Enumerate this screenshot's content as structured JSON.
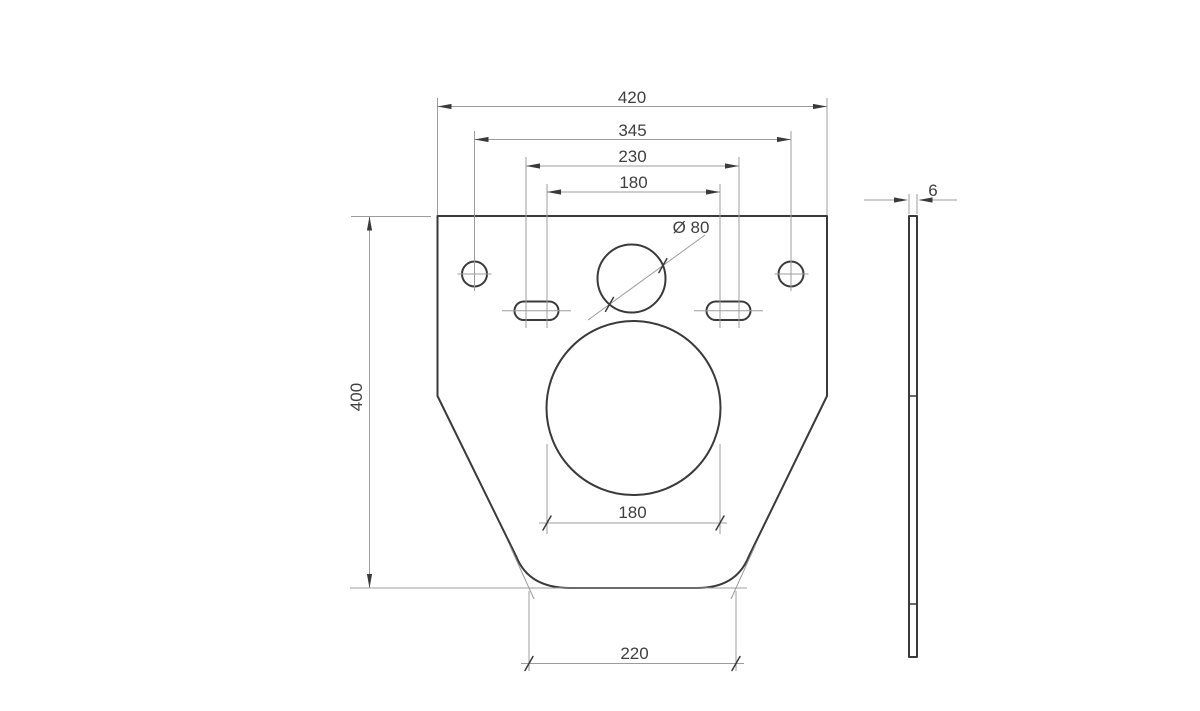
{
  "colors": {
    "outline": "#3a3a3a",
    "thin": "#9c9c9c",
    "text": "#3f3f3f",
    "background": "#ffffff"
  },
  "front_view": {
    "dims": {
      "overall_width": "420",
      "bolt_hole_spacing": "345",
      "slot_spacing": "230",
      "top_inner_width": "180",
      "overall_height": "400",
      "pipe_hole_diameter": "Ø 80",
      "opening_diameter": "180",
      "bottom_width": "220"
    }
  },
  "side_view": {
    "dims": {
      "thickness": "6"
    }
  }
}
